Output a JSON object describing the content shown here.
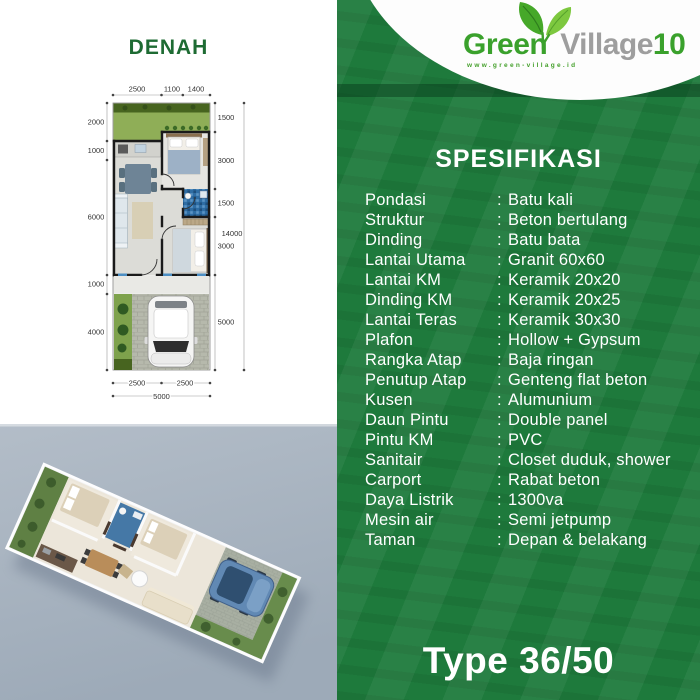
{
  "brand": {
    "name_green": "Green",
    "name_village": "Village",
    "name_number": "10",
    "website": "www.green-village.id"
  },
  "left_panel": {
    "title": "DENAH"
  },
  "floorplan_dims": {
    "top": [
      "2500",
      "1100",
      "1400"
    ],
    "left": [
      "2000",
      "1000",
      "6000",
      "1000",
      "4000"
    ],
    "right": [
      "1500",
      "3000",
      "1500",
      "3000",
      "5000"
    ],
    "right_total": "14000",
    "bottom": [
      "2500",
      "2500"
    ],
    "bottom_total": "5000"
  },
  "specs": {
    "heading": "SPESIFIKASI",
    "colon": ":",
    "items": [
      {
        "label": "Pondasi",
        "value": "Batu kali"
      },
      {
        "label": "Struktur",
        "value": "Beton bertulang"
      },
      {
        "label": "Dinding",
        "value": "Batu bata"
      },
      {
        "label": "Lantai Utama",
        "value": "Granit 60x60"
      },
      {
        "label": "Lantai KM",
        "value": "Keramik 20x20"
      },
      {
        "label": "Dinding KM",
        "value": "Keramik 20x25"
      },
      {
        "label": "Lantai Teras",
        "value": "Keramik 30x30"
      },
      {
        "label": "Plafon",
        "value": "Hollow + Gypsum"
      },
      {
        "label": "Rangka Atap",
        "value": "Baja ringan"
      },
      {
        "label": "Penutup Atap",
        "value": "Genteng flat beton"
      },
      {
        "label": "Kusen",
        "value": "Alumunium"
      },
      {
        "label": "Daun Pintu",
        "value": "Double panel"
      },
      {
        "label": "Pintu KM",
        "value": "PVC"
      },
      {
        "label": "Sanitair",
        "value": "Closet duduk, shower"
      },
      {
        "label": "Carport",
        "value": "Rabat beton"
      },
      {
        "label": "Daya Listrik",
        "value": "1300va"
      },
      {
        "label": "Mesin air",
        "value": "Semi jetpump"
      },
      {
        "label": "Taman",
        "value": "Depan & belakang"
      }
    ]
  },
  "footer": {
    "type_label": "Type 36/50"
  },
  "colors": {
    "panel_green": "#1e7a3c",
    "logo_green": "#3aa12c",
    "logo_gray": "#9e9e9e",
    "title_green": "#1e6b33",
    "render_bg": "#a7b2bf"
  }
}
